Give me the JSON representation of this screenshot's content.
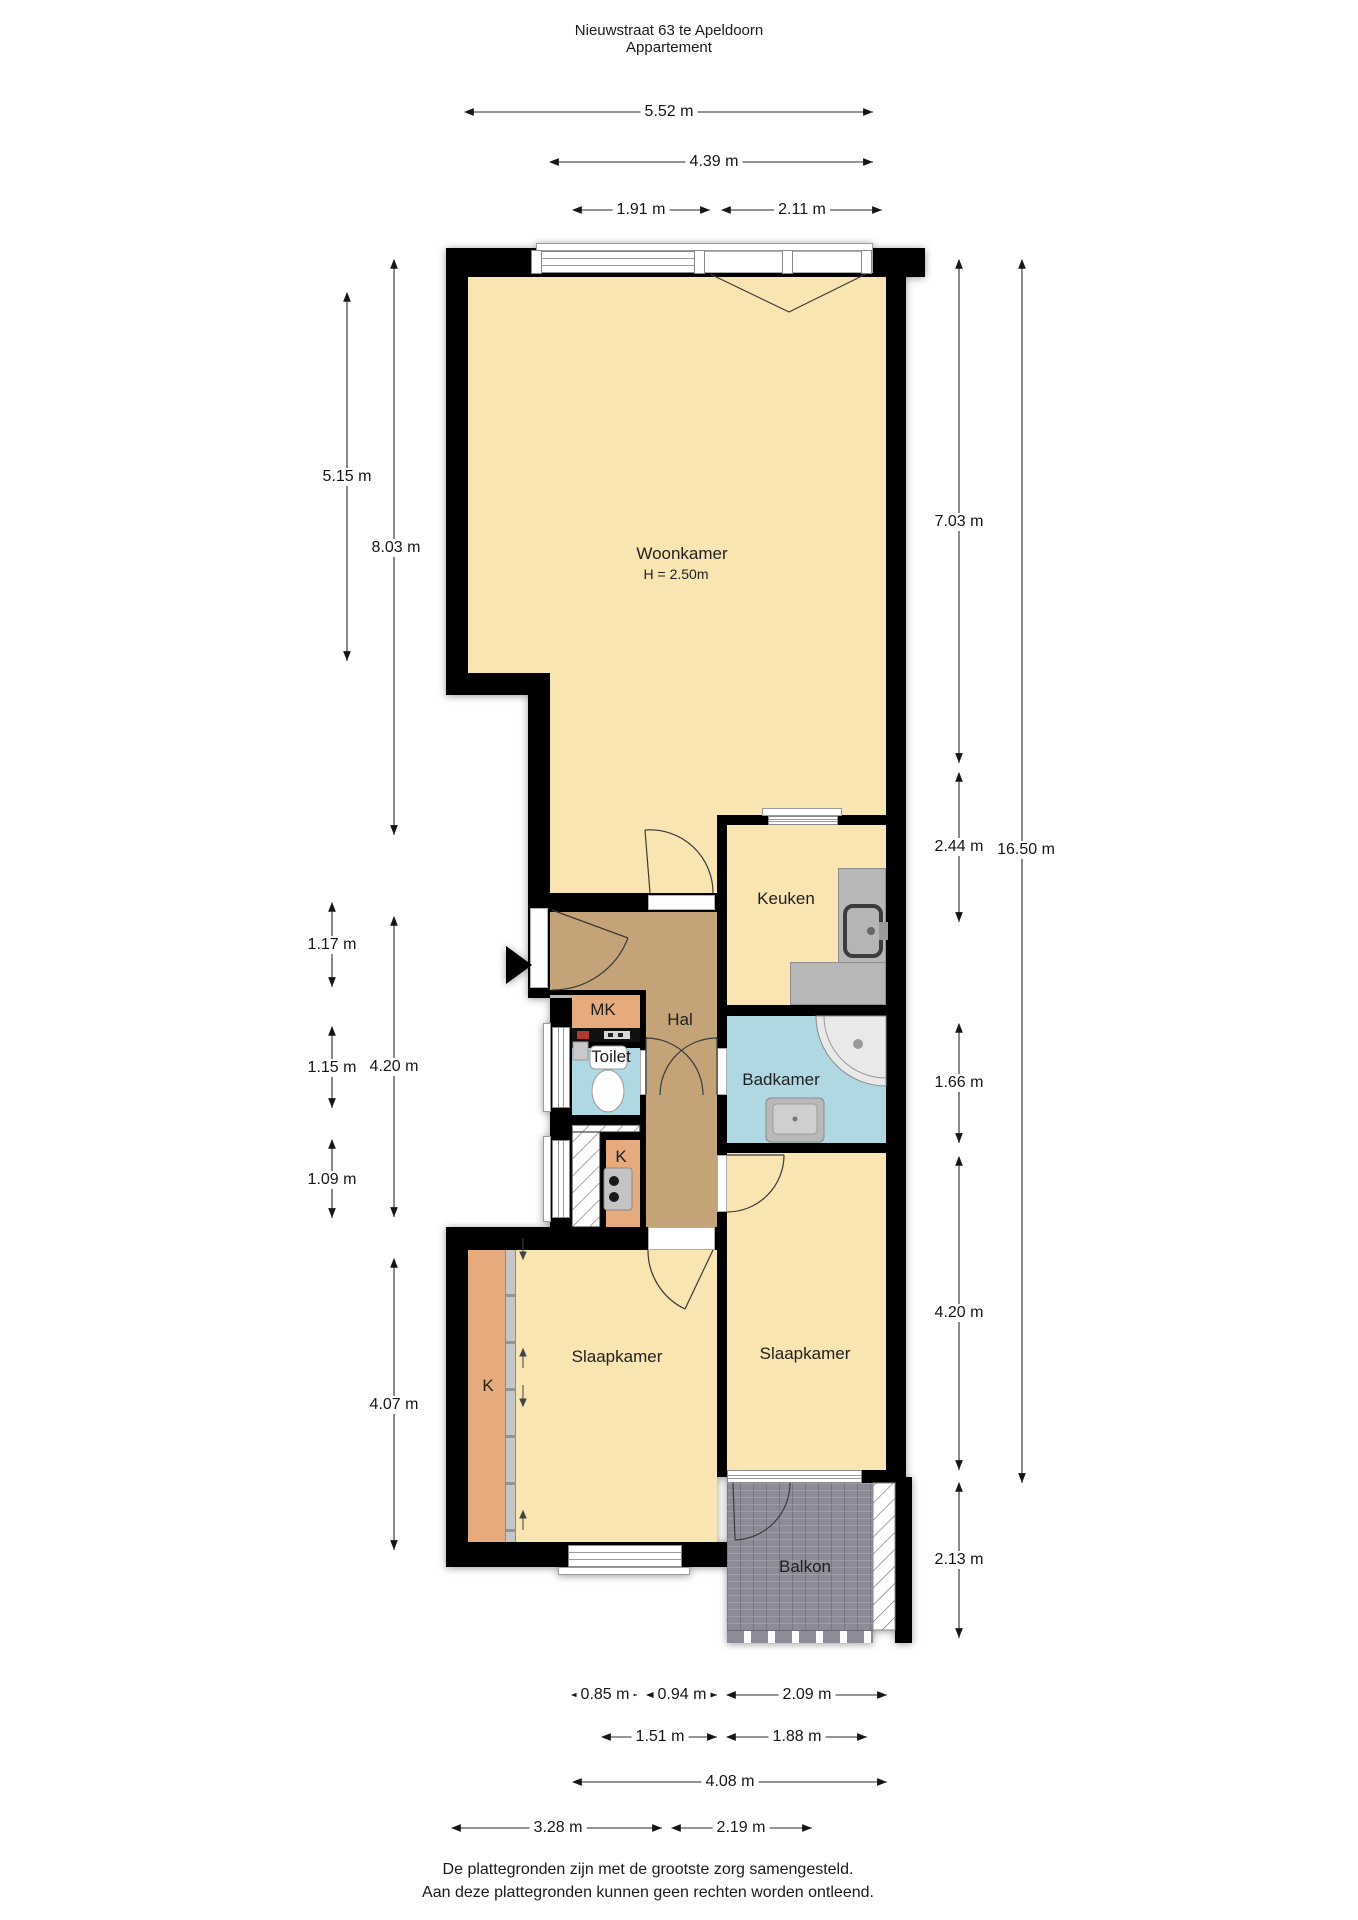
{
  "title": {
    "line1": "Nieuwstraat 63 te Apeldoorn",
    "line2": "Appartement"
  },
  "rooms": {
    "woonkamer": {
      "label": "Woonkamer",
      "height_note": "H = 2.50m"
    },
    "keuken": {
      "label": "Keuken"
    },
    "hal": {
      "label": "Hal"
    },
    "mk": {
      "label": "MK"
    },
    "toilet": {
      "label": "Toilet"
    },
    "badkamer": {
      "label": "Badkamer"
    },
    "kast_klein": {
      "label": "K"
    },
    "slaapkamer_links": {
      "label": "Slaapkamer"
    },
    "slaapkamer_rechts": {
      "label": "Slaapkamer"
    },
    "kast": {
      "label": "K"
    },
    "balkon": {
      "label": "Balkon"
    }
  },
  "dimensions": {
    "top": [
      "5.52 m",
      "4.39 m",
      "1.91 m",
      "2.11 m"
    ],
    "left": [
      "5.15 m",
      "8.03 m",
      "1.17 m",
      "1.15 m",
      "1.09 m",
      "4.20 m",
      "4.07 m"
    ],
    "right": [
      "7.03 m",
      "2.44 m",
      "16.50 m",
      "1.66 m",
      "4.20 m",
      "2.13 m"
    ],
    "bottom": [
      "0.85 m",
      "0.94 m",
      "2.09 m",
      "1.51 m",
      "1.88 m",
      "4.08 m",
      "3.28 m",
      "2.19 m"
    ]
  },
  "footer": {
    "line1": "De plattegronden zijn met de grootste zorg samengesteld.",
    "line2": "Aan deze plattegronden kunnen geen rechten worden ontleend."
  },
  "colors": {
    "wall": "#000000",
    "room": "#F8E5B2",
    "hall": "#C3A377",
    "wet": "#AFD8E3",
    "closet": "#E5AB7D",
    "balcony": "#8E8B98"
  }
}
